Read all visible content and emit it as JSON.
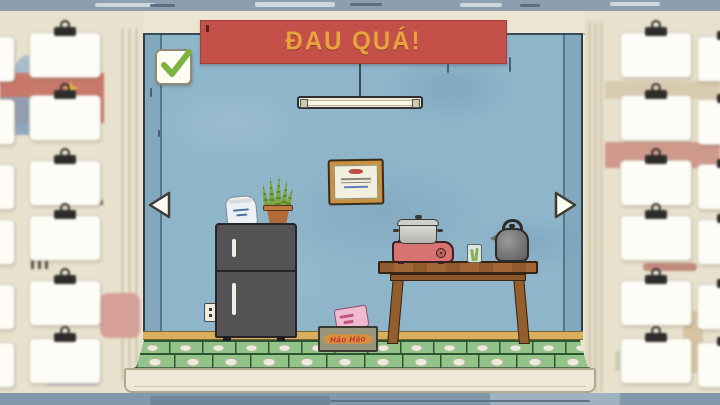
{
  "scene": {
    "banner": {
      "text": "ĐAU QUÁ!",
      "bg_color": "#c4504a",
      "text_color": "#e8a43c"
    },
    "checkbox": {
      "state": "checked",
      "check_color": "#7cb342"
    },
    "navigation": {
      "left": "previous-view",
      "right": "next-view"
    },
    "objects": {
      "noodle_box_label": "Hảo Hảo",
      "items": [
        "fluorescent-lamp",
        "framed-certificate",
        "refrigerator",
        "flour-bag",
        "potted-snake-plant",
        "power-outlet",
        "wooden-table",
        "portable-gas-stove",
        "cooking-pot",
        "glass-cup",
        "kettle",
        "noodle-box"
      ]
    },
    "colors": {
      "wall_blue": "#8fb5cb",
      "floor_tile_green": "#92c48a",
      "banner_red": "#c4504a",
      "banner_text_yellow": "#e8a43c",
      "table_wood": "#a06633",
      "fridge_gray": "#555256",
      "ceiling_gray": "#8b9fae"
    },
    "side_panels": {
      "left": {
        "card_count": 12
      },
      "right": {
        "card_count": 12
      }
    }
  }
}
